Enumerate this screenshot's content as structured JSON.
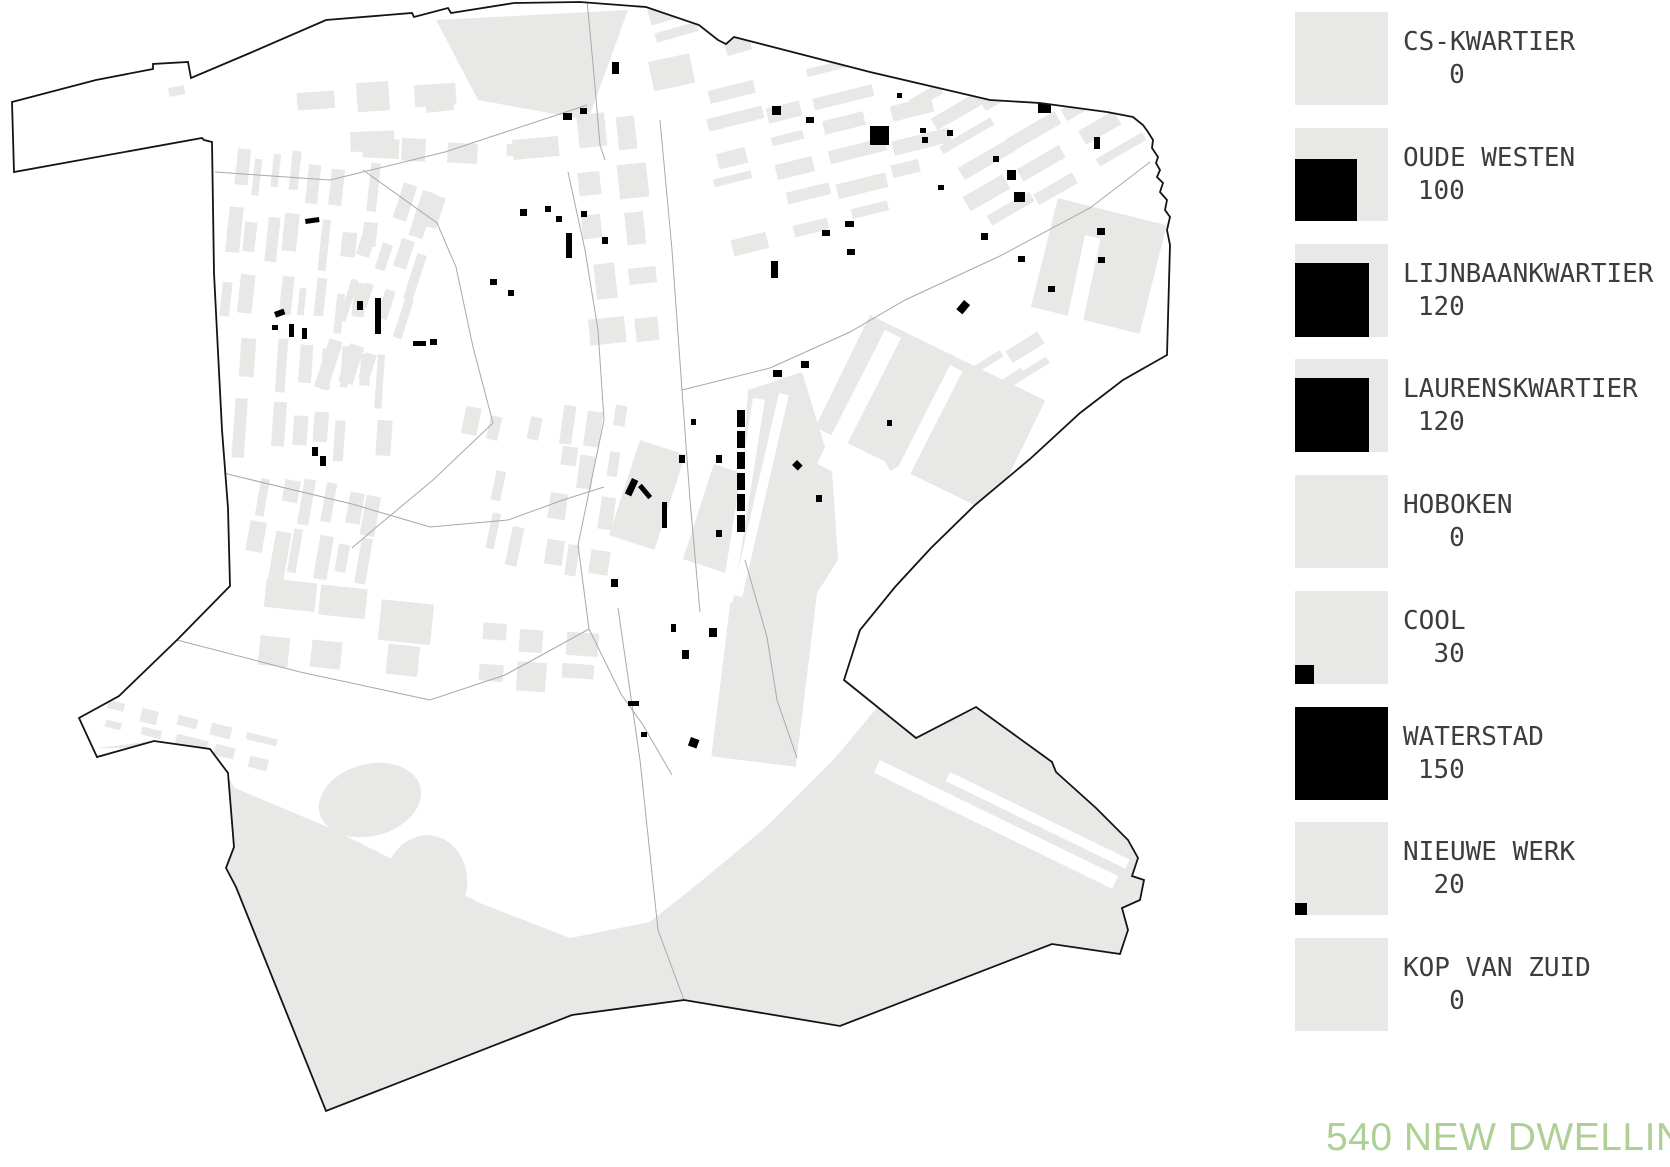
{
  "colors": {
    "background": "#ffffff",
    "fabric_gray": "#e8e8e7",
    "boundary_black": "#141414",
    "district_line_gray": "#a9a9a9",
    "dwelling_mark_black": "#000000",
    "legend_text": "#3d3d3d",
    "accent_green": "#aed094"
  },
  "legend": {
    "items": [
      {
        "name": "CS-KWARTIER",
        "count": "0",
        "black_side": 0
      },
      {
        "name": "OUDE WESTEN",
        "count": "100",
        "black_side": 62
      },
      {
        "name": "LIJNBAANKWARTIER",
        "count": "120",
        "black_side": 74
      },
      {
        "name": "LAURENSKWARTIER",
        "count": "120",
        "black_side": 74
      },
      {
        "name": "HOBOKEN",
        "count": "0",
        "black_side": 0
      },
      {
        "name": "COOL",
        "count": "30",
        "black_side": 19
      },
      {
        "name": "WATERSTAD",
        "count": "150",
        "black_side": 93
      },
      {
        "name": "NIEUWE WERK",
        "count": "20",
        "black_side": 12
      },
      {
        "name": "KOP VAN ZUID",
        "count": "0",
        "black_side": 0
      }
    ]
  },
  "footer": {
    "title": "540 NEW DWELLINGS"
  },
  "map": {
    "boundary_path": "M12,102 L96,80 L153,69 L153,64 L188,62 L191,78 L250,53 L326,20 L412,13 L414,17 L448,8 L451,13 L514,3 L580,2 L646,7 L699,25 L718,40 L726,44 L734,37 L870,72 L990,100 L1040,103 L1107,112 L1133,117 L1143,125 L1148,132 L1153,140 L1152,148 L1158,157 L1156,163 L1160,170 L1157,177 L1163,183 L1160,192 L1167,200 L1165,210 L1170,217 L1167,230 L1170,245 L1167,355 L1123,380 L1080,413 L1030,459 L975,505 L931,548 L895,587 L860,630 L844,680 L916,738 L976,707 L1052,762 L1056,772 L1096,808 L1128,840 L1138,858 L1132,876 L1144,880 L1140,900 L1122,908 L1128,930 L1120,954 L1052,944 L840,1026 L684,1000 L572,1015 L326,1111 L236,887 L226,868 L234,847 L228,773 L210,749 L154,741 L97,757 L79,718 L119,696 L177,640 L230,586 L228,508 L222,430 L218,352 L214,273 L212,142 L204,140 L202,138 L14,172 Z",
    "district_lines": [
      "M587,0 L594,75 L600,145 L605,160",
      "M215,172 L330,180 L445,152 L587,105",
      "M682,390 L770,368 L850,332 L905,300 L1000,256 L1090,208 L1150,162",
      "M568,172 L585,250 L598,330 L604,420 L578,545 L589,629 L621,694 L643,725 L672,775",
      "M177,640 L300,672 L430,700 L505,675 L540,656 L589,629",
      "M223,473 L352,504 L430,527 L508,520 L563,500 L604,487",
      "M660,120 L672,250 L682,390 L690,500 L700,612",
      "M745,560 L767,637 L777,700 L797,758",
      "M618,608 L640,760 L658,930 L684,1000",
      "M363,170 L437,223 L456,267 L473,347 L493,423",
      "M493,423 L433,480 L373,530 L352,548"
    ],
    "gray_areas": [
      "M436,20 L628,10 L588,120 L478,100 Z",
      "M97,748 L210,748 L235,788 L330,828 L480,903 L570,938 L650,922 L705,878 L765,828 L835,758 L885,698 L925,638 L985,568 L1045,498 L1095,448 L1135,408 L1167,357 L1121,381 L1078,414 L1028,460 L973,506 L929,549 L893,588 L858,631 L844,680 L916,738 L976,707 L1052,762 L1096,808 L1128,840 L1138,858 L1132,876 L1144,880 L1140,900 L1122,908 L1128,930 L1120,954 L1052,944 L840,1026 L684,1000 L572,1015 L326,1111 L236,887 L226,868 L234,847 L228,773 L210,749 L154,741 Z",
      "M748,390 L802,372 L832,470 L838,560 L805,612 L760,600 L742,480 Z"
    ],
    "gray_rects": [
      [
        640,
        440,
        200,
        100,
        18
      ],
      [
        870,
        315,
        195,
        125,
        26
      ],
      [
        1058,
        198,
        112,
        112,
        14
      ],
      [
        737,
        548,
        85,
        210,
        7
      ],
      [
        425,
        100,
        28,
        13,
        -6
      ],
      [
        168,
        88,
        16,
        9,
        -10
      ],
      [
        648,
        62,
        42,
        30,
        -12
      ],
      [
        512,
        140,
        46,
        20,
        -5
      ],
      [
        350,
        132,
        44,
        20,
        -2
      ]
    ],
    "blobs": [
      [
        370,
        800,
        52,
        36,
        -15
      ],
      [
        425,
        885,
        42,
        50,
        10
      ],
      [
        352,
        958,
        36,
        28,
        -5
      ],
      [
        447,
        998,
        28,
        23,
        20
      ],
      [
        388,
        1046,
        23,
        17,
        0
      ]
    ],
    "white_cuts": [
      [
        695,
        425,
        30,
        175,
        18
      ],
      [
        885,
        330,
        18,
        150,
        27
      ],
      [
        950,
        365,
        14,
        130,
        27
      ],
      [
        1085,
        235,
        16,
        95,
        12
      ],
      [
        880,
        760,
        265,
        14,
        26
      ],
      [
        950,
        772,
        200,
        10,
        26
      ],
      [
        1002,
        688,
        10,
        135,
        -64
      ],
      [
        753,
        398,
        12,
        205,
        9
      ],
      [
        779,
        393,
        10,
        207,
        13
      ]
    ],
    "clusters": [
      {
        "x": 236,
        "y": 152,
        "rot": 6,
        "cols": 8,
        "rows": 3,
        "bw": 11,
        "bh": 40,
        "px": 19,
        "py": 62,
        "skip": 0.12,
        "seed": 1
      },
      {
        "x": 240,
        "y": 342,
        "rot": 4,
        "cols": 8,
        "rows": 2,
        "bw": 11,
        "bh": 44,
        "px": 20,
        "py": 64,
        "skip": 0.15,
        "seed": 2
      },
      {
        "x": 262,
        "y": 472,
        "rot": 10,
        "cols": 6,
        "rows": 2,
        "bw": 12,
        "bh": 36,
        "px": 22,
        "py": 52,
        "skip": 0.2,
        "seed": 3
      },
      {
        "x": 382,
        "y": 177,
        "rot": 18,
        "cols": 4,
        "rows": 4,
        "bw": 11,
        "bh": 38,
        "px": 20,
        "py": 55,
        "skip": 0.15,
        "seed": 4
      },
      {
        "x": 468,
        "y": 408,
        "rot": 12,
        "cols": 4,
        "rows": 3,
        "bw": 12,
        "bh": 34,
        "px": 22,
        "py": 50,
        "skip": 0.15,
        "seed": 5
      },
      {
        "x": 572,
        "y": 120,
        "rot": -6,
        "cols": 2,
        "rows": 5,
        "bw": 28,
        "bh": 26,
        "px": 44,
        "py": 50,
        "skip": 0.1,
        "seed": 6
      },
      {
        "x": 566,
        "y": 402,
        "rot": 8,
        "cols": 3,
        "rows": 4,
        "bw": 14,
        "bh": 30,
        "px": 24,
        "py": 46,
        "skip": 0.12,
        "seed": 7
      },
      {
        "x": 300,
        "y": 90,
        "rot": -4,
        "cols": 3,
        "rows": 1,
        "bw": 42,
        "bh": 22,
        "px": 56,
        "py": 30,
        "skip": 0,
        "seed": 8
      },
      {
        "x": 652,
        "y": 6,
        "rot": -16,
        "cols": 6,
        "rows": 3,
        "bw": 42,
        "bh": 13,
        "px": 56,
        "py": 26,
        "skip": 0.18,
        "seed": 9
      },
      {
        "x": 700,
        "y": 93,
        "rot": -14,
        "cols": 4,
        "rows": 6,
        "bw": 44,
        "bh": 12,
        "px": 58,
        "py": 30,
        "skip": 0.15,
        "seed": 10
      },
      {
        "x": 915,
        "y": 98,
        "rot": -30,
        "cols": 4,
        "rows": 6,
        "bw": 46,
        "bh": 12,
        "px": 60,
        "py": 28,
        "skip": 0.18,
        "seed": 11
      },
      {
        "x": 848,
        "y": 418,
        "rot": -32,
        "cols": 4,
        "rows": 3,
        "bw": 44,
        "bh": 11,
        "px": 56,
        "py": 26,
        "skip": 0.15,
        "seed": 12
      },
      {
        "x": 1062,
        "y": 598,
        "rot": -28,
        "cols": 3,
        "rows": 4,
        "bw": 34,
        "bh": 12,
        "px": 46,
        "py": 24,
        "skip": 0.2,
        "seed": 13
      },
      {
        "x": 478,
        "y": 623,
        "rot": 4,
        "cols": 3,
        "rows": 2,
        "bw": 30,
        "bh": 24,
        "px": 42,
        "py": 38,
        "skip": 0.1,
        "seed": 14
      },
      {
        "x": 263,
        "y": 583,
        "rot": 6,
        "cols": 3,
        "rows": 2,
        "bw": 48,
        "bh": 34,
        "px": 62,
        "py": 52,
        "skip": 0.1,
        "seed": 15
      },
      {
        "x": 112,
        "y": 700,
        "rot": 14,
        "cols": 5,
        "rows": 2,
        "bw": 26,
        "bh": 11,
        "px": 36,
        "py": 19,
        "skip": 0.15,
        "seed": 16
      },
      {
        "x": 310,
        "y": 133,
        "rot": 3,
        "cols": 5,
        "rows": 1,
        "bw": 34,
        "bh": 18,
        "px": 48,
        "py": 24,
        "skip": 0.1,
        "seed": 17
      }
    ],
    "marks": [
      [
        305,
        219,
        14,
        5,
        -8
      ],
      [
        274,
        312,
        10,
        6,
        -20
      ],
      [
        272,
        325,
        6,
        5,
        0
      ],
      [
        289,
        324,
        5,
        13,
        0
      ],
      [
        302,
        328,
        5,
        11,
        0
      ],
      [
        357,
        301,
        6,
        9,
        0
      ],
      [
        375,
        298,
        6,
        36,
        0
      ],
      [
        413,
        341,
        13,
        5,
        0
      ],
      [
        430,
        339,
        7,
        6,
        0
      ],
      [
        320,
        456,
        6,
        10,
        0
      ],
      [
        312,
        447,
        6,
        9,
        0
      ],
      [
        566,
        233,
        6,
        25,
        0
      ],
      [
        520,
        209,
        7,
        7,
        0
      ],
      [
        545,
        206,
        6,
        6,
        0
      ],
      [
        556,
        216,
        6,
        6,
        0
      ],
      [
        581,
        211,
        6,
        6,
        0
      ],
      [
        602,
        237,
        6,
        7,
        0
      ],
      [
        490,
        279,
        7,
        6,
        0
      ],
      [
        508,
        290,
        6,
        6,
        0
      ],
      [
        563,
        113,
        9,
        7,
        0
      ],
      [
        580,
        108,
        7,
        6,
        0
      ],
      [
        612,
        62,
        7,
        12,
        0
      ],
      [
        870,
        126,
        19,
        19,
        0
      ],
      [
        897,
        93,
        5,
        5,
        0
      ],
      [
        838,
        56,
        6,
        6,
        0
      ],
      [
        920,
        128,
        6,
        5,
        0
      ],
      [
        947,
        130,
        6,
        6,
        0
      ],
      [
        922,
        137,
        6,
        6,
        0
      ],
      [
        993,
        156,
        6,
        6,
        0
      ],
      [
        1007,
        170,
        9,
        10,
        0
      ],
      [
        1014,
        192,
        11,
        10,
        0
      ],
      [
        938,
        185,
        6,
        5,
        0
      ],
      [
        1094,
        137,
        6,
        12,
        0
      ],
      [
        1038,
        103,
        13,
        10,
        0
      ],
      [
        772,
        106,
        9,
        9,
        0
      ],
      [
        806,
        117,
        8,
        6,
        0
      ],
      [
        845,
        221,
        9,
        6,
        0
      ],
      [
        822,
        230,
        8,
        6,
        0
      ],
      [
        847,
        249,
        8,
        6,
        0
      ],
      [
        771,
        261,
        7,
        17,
        0
      ],
      [
        981,
        233,
        7,
        7,
        0
      ],
      [
        1097,
        228,
        8,
        7,
        0
      ],
      [
        1098,
        257,
        7,
        6,
        0
      ],
      [
        737,
        410,
        8,
        17,
        0
      ],
      [
        737,
        431,
        8,
        17,
        0
      ],
      [
        737,
        452,
        8,
        17,
        0
      ],
      [
        737,
        473,
        8,
        17,
        0
      ],
      [
        737,
        494,
        8,
        17,
        0
      ],
      [
        737,
        515,
        8,
        17,
        0
      ],
      [
        773,
        370,
        9,
        7,
        0
      ],
      [
        801,
        361,
        8,
        7,
        0
      ],
      [
        691,
        419,
        5,
        6,
        0
      ],
      [
        679,
        455,
        6,
        8,
        0
      ],
      [
        716,
        455,
        6,
        8,
        0
      ],
      [
        632,
        478,
        7,
        17,
        25
      ],
      [
        638,
        487,
        5,
        16,
        -40
      ],
      [
        662,
        502,
        5,
        26,
        0
      ],
      [
        716,
        530,
        6,
        7,
        0
      ],
      [
        797,
        460,
        8,
        7,
        45
      ],
      [
        816,
        495,
        6,
        7,
        0
      ],
      [
        964,
        300,
        8,
        12,
        40
      ],
      [
        1018,
        256,
        7,
        6,
        0
      ],
      [
        1048,
        286,
        7,
        6,
        0
      ],
      [
        887,
        420,
        5,
        6,
        0
      ],
      [
        611,
        579,
        7,
        8,
        0
      ],
      [
        671,
        624,
        5,
        8,
        0
      ],
      [
        709,
        628,
        8,
        9,
        0
      ],
      [
        682,
        650,
        7,
        9,
        0
      ],
      [
        628,
        701,
        11,
        5,
        0
      ],
      [
        641,
        732,
        6,
        5,
        0
      ],
      [
        691,
        737,
        9,
        9,
        20
      ]
    ]
  }
}
